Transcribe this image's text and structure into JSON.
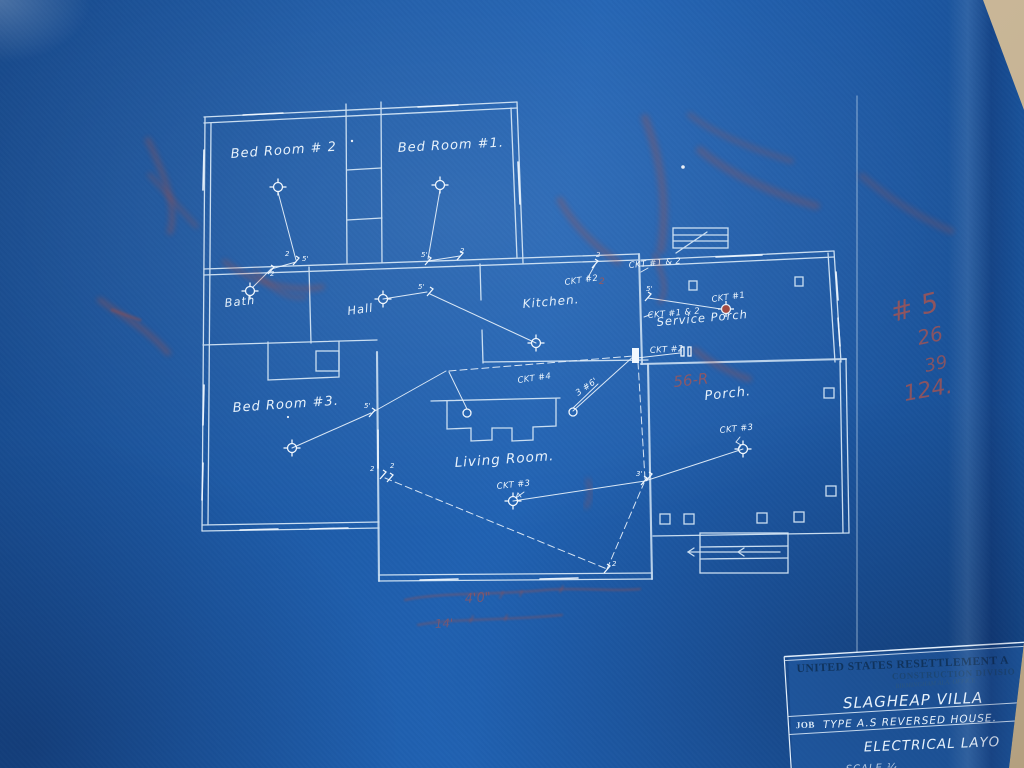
{
  "document": {
    "kind": "blueprint electrical floor plan photograph"
  },
  "rooms": [
    {
      "label": "Bed Room # 2"
    },
    {
      "label": "Bed Room #1."
    },
    {
      "label": "Bath"
    },
    {
      "label": "Hall"
    },
    {
      "label": "Kitchen."
    },
    {
      "label": "Service Porch"
    },
    {
      "label": "Bed Room #3."
    },
    {
      "label": "Living Room."
    },
    {
      "label": "Porch."
    }
  ],
  "circuits": [
    {
      "label": "CKT #2"
    },
    {
      "label": "CKT #1 & 2"
    },
    {
      "label": "CKT #1 & 2"
    },
    {
      "label": "CKT #1"
    },
    {
      "label": "CKT #2"
    },
    {
      "label": "CKT #4"
    },
    {
      "label": "3 #6'"
    },
    {
      "label": "CKT #3"
    },
    {
      "label": "CKT #3"
    }
  ],
  "marks": [
    "2",
    "5'",
    "2",
    "5'",
    "2",
    "5'",
    "2",
    "5'",
    "5'",
    "2",
    "2",
    "3'",
    "2"
  ],
  "title_block": {
    "agency": "UNITED STATES RESETTLEMENT A",
    "division": "CONSTRUCTION DIVISIO",
    "office": "BIRMINGHAM ALA. OFFICE",
    "project": "SLAGHEAP  VILLA",
    "job_prefix": "JOB",
    "job": "TYPE  A.S REVERSED  HOUSE.",
    "drawing_title": "ELECTRICAL  LAYO",
    "scale_fragment": "SCALE  ¼"
  },
  "red_annotations": {
    "margin_numbers": [
      "# 5",
      "26",
      "39",
      "124."
    ],
    "near_panel": "56-R",
    "bottom_fragment_1": "4'0\"",
    "bottom_fragment_2": "14'"
  },
  "colors": {
    "paper_blue": "#1d5aa6",
    "line_white": "#d9eaf8",
    "red_pencil": "#b5544a",
    "photo_backing": "#c8b596"
  }
}
